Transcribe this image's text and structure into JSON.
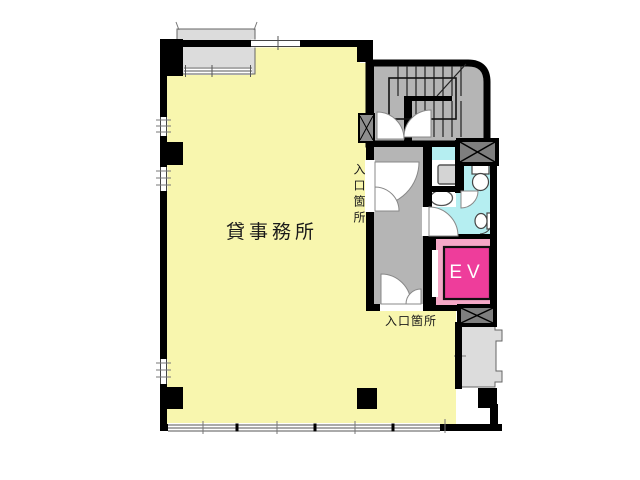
{
  "floorplan": {
    "office_label": "貸事務所",
    "elevator_label": "EV",
    "entrance_side_label": "入口箇所",
    "entrance_bottom_label": "入口箇所"
  },
  "colors": {
    "office_fill": "#f8f6ae",
    "corridor_fill": "#b5b5b5",
    "stair_fill": "#b5b5b5",
    "bath_fill": "#b5eef1",
    "balcony_fill": "#dcdcdc",
    "elevator_frame_fill": "#f5a8c7",
    "elevator_car_fill": "#ee3d9b",
    "shaft_fill": "#7e7e7e",
    "wall": "#000000"
  }
}
